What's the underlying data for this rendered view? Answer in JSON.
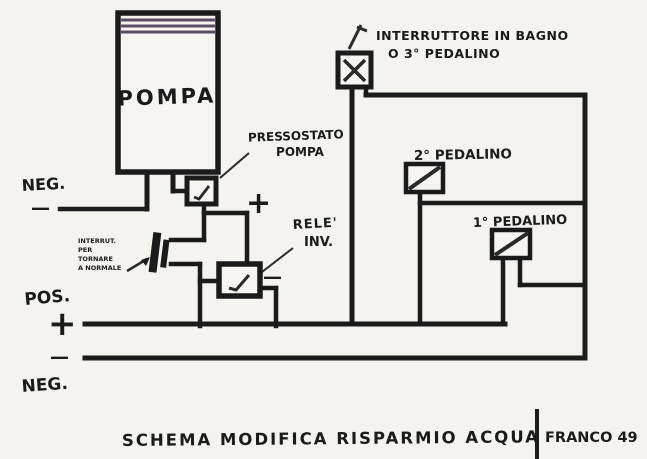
{
  "diagram": {
    "caption": "SCHEMA MODIFICA RISPARMIO ACQUA",
    "author": "FRANCO 49",
    "components": {
      "pompa": {
        "label": "POMPA"
      },
      "pressostato": {
        "label_line1": "PRESSOSTATO",
        "label_line2": "POMPA"
      },
      "rele": {
        "label_line1": "RELE'",
        "label_line2": "INV."
      },
      "interruttore_bagno": {
        "label_line1": "INTERRUTTORE IN BAGNO",
        "label_line2": "O 3° PEDALINO"
      },
      "pedalino2": {
        "label": "2° PEDALINO"
      },
      "pedalino1": {
        "label": "1° PEDALINO"
      },
      "nota_ritorno_normale": {
        "lines": [
          "INTERRUT.",
          "PER",
          "TORNARE",
          "A NORMALE"
        ]
      }
    },
    "rails": {
      "neg_top": {
        "label": "NEG.",
        "symbol": "—"
      },
      "pos_bottom": {
        "label": "POS.",
        "symbol": "+"
      },
      "neg_bottom": {
        "label": "NEG.",
        "symbol": "—"
      },
      "plus_mid": "+",
      "minus_mid": "—"
    },
    "colors": {
      "ink": "#1b1b1b",
      "paper": "#f4f3f0",
      "stripe": "#5c4f63"
    }
  }
}
